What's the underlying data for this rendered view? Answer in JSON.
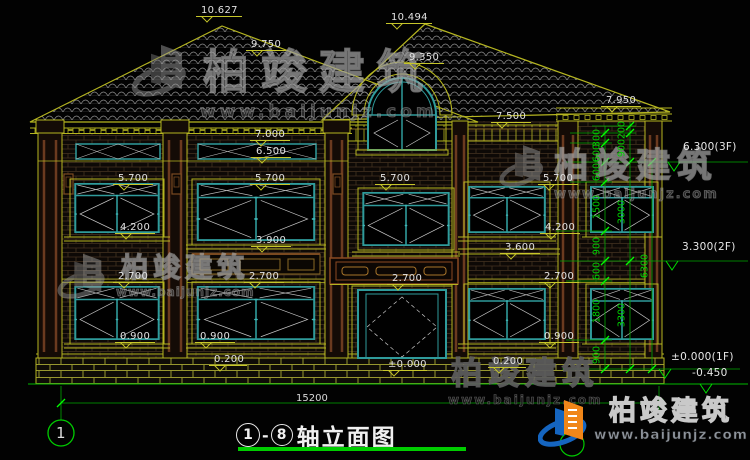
{
  "drawing": {
    "title": {
      "axis_start": "1",
      "axis_end": "8",
      "dash": "-",
      "name": "轴立面图"
    },
    "bottom_dimension": "15200",
    "axis_bubble_left": "1",
    "axis_bubble_right": "8"
  },
  "watermark": {
    "name": "柏竣建筑",
    "url": "www.baijunjz.com"
  },
  "logo": {
    "name": "柏竣建筑",
    "url": "www.baijunjz.com"
  },
  "colors": {
    "dim_green": "#00cc00",
    "cad_yellow": "#b5b520",
    "frame_teal": "#2f9b9b",
    "text_white": "#e2e2e2",
    "wood_brown": "#8a4a22",
    "logo_blue": "#1565c0",
    "logo_orange": "#f08619"
  },
  "elevation_labels": [
    {
      "t": "10.627",
      "x": 196,
      "y": 6,
      "w": 46
    },
    {
      "t": "9.750",
      "x": 246,
      "y": 40,
      "w": 40
    },
    {
      "t": "10.494",
      "x": 386,
      "y": 13,
      "w": 46
    },
    {
      "t": "9.350",
      "x": 404,
      "y": 53,
      "w": 40
    },
    {
      "t": "7.950",
      "x": 601,
      "y": 96,
      "w": 40
    },
    {
      "t": "7.500",
      "x": 491,
      "y": 112,
      "w": 40
    },
    {
      "t": "7.000",
      "x": 250,
      "y": 130,
      "w": 40
    },
    {
      "t": "6.500",
      "x": 251,
      "y": 147,
      "w": 40
    },
    {
      "t": "5.700",
      "x": 113,
      "y": 174,
      "w": 40
    },
    {
      "t": "5.700",
      "x": 250,
      "y": 174,
      "w": 40
    },
    {
      "t": "5.700",
      "x": 375,
      "y": 174,
      "w": 40
    },
    {
      "t": "5.700",
      "x": 538,
      "y": 174,
      "w": 40
    },
    {
      "t": "4.200",
      "x": 115,
      "y": 223,
      "w": 40
    },
    {
      "t": "4.200",
      "x": 540,
      "y": 223,
      "w": 40
    },
    {
      "t": "3.900",
      "x": 251,
      "y": 236,
      "w": 40
    },
    {
      "t": "3.600",
      "x": 500,
      "y": 243,
      "w": 40
    },
    {
      "t": "2.700",
      "x": 113,
      "y": 272,
      "w": 40
    },
    {
      "t": "2.700",
      "x": 244,
      "y": 272,
      "w": 40
    },
    {
      "t": "2.700",
      "x": 387,
      "y": 274,
      "w": 40
    },
    {
      "t": "2.700",
      "x": 539,
      "y": 272,
      "w": 40
    },
    {
      "t": "0.900",
      "x": 115,
      "y": 332,
      "w": 40
    },
    {
      "t": "0.900",
      "x": 195,
      "y": 332,
      "w": 40
    },
    {
      "t": "0.900",
      "x": 539,
      "y": 332,
      "w": 40
    },
    {
      "t": "0.200",
      "x": 209,
      "y": 355,
      "w": 38
    },
    {
      "t": "0.200",
      "x": 488,
      "y": 357,
      "w": 38
    },
    {
      "t": "±0.000",
      "x": 383,
      "y": 360,
      "w": 44
    }
  ],
  "level_texts": [
    {
      "t": "6.300(3F)",
      "x": 683,
      "y": 142
    },
    {
      "t": "3.300(2F)",
      "x": 682,
      "y": 242
    },
    {
      "t": "±0.000(1F)",
      "x": 671,
      "y": 352
    },
    {
      "t": "-0.450",
      "x": 692,
      "y": 368
    }
  ],
  "vertical_dims": [
    {
      "t": "300",
      "x": 597,
      "y": 138
    },
    {
      "t": "600",
      "x": 597,
      "y": 153
    },
    {
      "t": "600",
      "x": 597,
      "y": 172
    },
    {
      "t": "1500",
      "x": 597,
      "y": 207
    },
    {
      "t": "900",
      "x": 597,
      "y": 246
    },
    {
      "t": "600",
      "x": 597,
      "y": 271
    },
    {
      "t": "1800",
      "x": 597,
      "y": 311
    },
    {
      "t": "900",
      "x": 597,
      "y": 355
    },
    {
      "t": "200",
      "x": 622,
      "y": 130
    },
    {
      "t": "900",
      "x": 622,
      "y": 148
    },
    {
      "t": "3000",
      "x": 622,
      "y": 212
    },
    {
      "t": "3300",
      "x": 622,
      "y": 315
    },
    {
      "t": "6300",
      "x": 645,
      "y": 266
    }
  ]
}
